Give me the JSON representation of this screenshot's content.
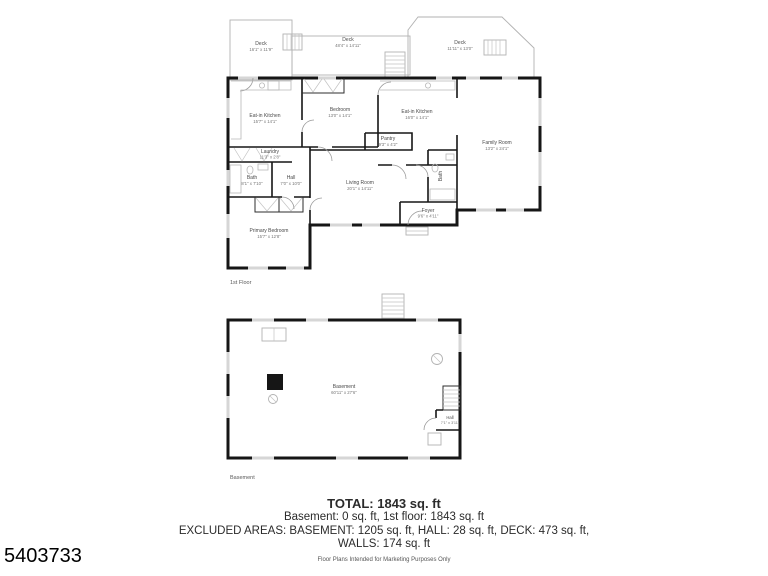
{
  "meta": {
    "listing_id": "5403733",
    "disclaimer": "Floor Plans Intended for Marketing Purposes Only"
  },
  "summary": {
    "total": "TOTAL: 1843 sq. ft",
    "floors": "Basement: 0 sq. ft, 1st floor: 1843 sq. ft",
    "excluded_line1": "EXCLUDED AREAS: BASEMENT: 1205 sq. ft, HALL: 28 sq. ft, DECK: 473 sq. ft,",
    "excluded_line2": "WALLS: 174 sq. ft"
  },
  "first_floor": {
    "caption": "1st Floor",
    "rooms": {
      "deck_left": {
        "name": "Deck",
        "dims": "16'1\" x 11'9\""
      },
      "deck_mid": {
        "name": "Deck",
        "dims": "48'4\" x 14'11\""
      },
      "deck_right": {
        "name": "Deck",
        "dims": "11'11\" x 13'0\""
      },
      "eat_in_kitchen_left": {
        "name": "Eat-in Kitchen",
        "dims": "15'7\" x 14'1\""
      },
      "bedroom": {
        "name": "Bedroom",
        "dims": "13'0\" x 14'1\""
      },
      "eat_in_kitchen_right": {
        "name": "Eat-in Kitchen",
        "dims": "16'0\" x 14'1\""
      },
      "family_room": {
        "name": "Family Room",
        "dims": "13'2\" x 24'1\""
      },
      "laundry": {
        "name": "Laundry",
        "dims": "11'3\" x 2'8\""
      },
      "bath": {
        "name": "Bath",
        "dims": "8'1\" x 7'10\""
      },
      "hall": {
        "name": "Hall",
        "dims": "7'0\" x 10'0\""
      },
      "pantry": {
        "name": "Pantry",
        "dims": "9'3\" x 4'2\""
      },
      "living_room": {
        "name": "Living Room",
        "dims": "20'1\" x 14'11\""
      },
      "bath_2": {
        "name": "Bath"
      },
      "foyer": {
        "name": "Foyer",
        "dims": "9'6\" x 4'11\""
      },
      "primary_bedroom": {
        "name": "Primary Bedroom",
        "dims": "15'7\" x 12'8\""
      }
    }
  },
  "basement": {
    "caption": "Basement",
    "rooms": {
      "main": {
        "name": "Basement",
        "dims": "60'11\" x 27'6\""
      },
      "hall": {
        "name": "Hall",
        "dims": "7'1\" x 3'11\""
      }
    }
  }
}
